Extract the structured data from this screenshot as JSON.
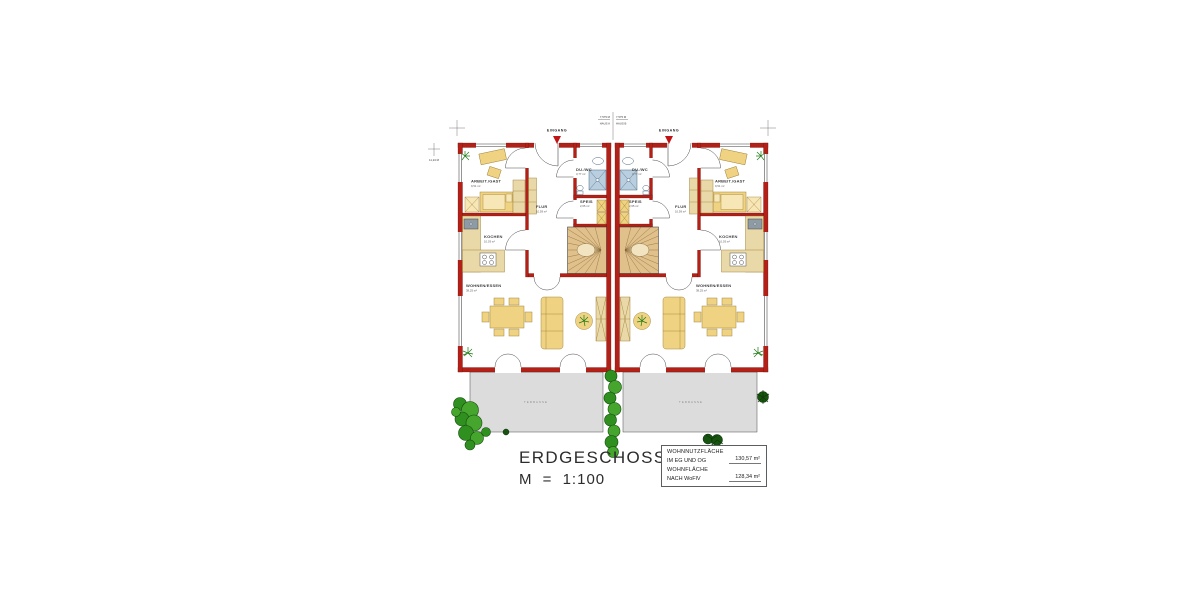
{
  "plan": {
    "title": "ERDGESCHOSS",
    "scale": "M = 1:100",
    "eingang_label": "EINGANG",
    "terrasse_label": "TERRASSE",
    "dims": {
      "width_a": "7,575 M",
      "width_b": "7,575 M",
      "haus_a": "HAUS A",
      "haus_b": "HAUS B",
      "height": "11,24 M"
    },
    "rooms": {
      "arbeit_gast": {
        "name": "ARBEIT./GAST",
        "area": "9,51 m²"
      },
      "du_wc": {
        "name": "DU./WC",
        "area": "3,77 m²"
      },
      "speis": {
        "name": "SPEIS",
        "area": "2,65 m²"
      },
      "flur": {
        "name": "FLUR",
        "area": "10,59 m²"
      },
      "kochen": {
        "name": "KOCHEN",
        "area": "10,03 m²"
      },
      "wohnen_essen": {
        "name": "WOHNEN/ESSEN",
        "area": "38,25 m²"
      }
    },
    "info_box": {
      "rows": [
        {
          "label_line1": "WOHNNUTZFLÄCHE",
          "label_line2": "IM EG UND OG",
          "value": "130,57 m²"
        },
        {
          "label_line1": "WOHNFLÄCHE",
          "label_line2": "NACH WoFlV",
          "value": "128,34 m²"
        }
      ]
    },
    "colors": {
      "wall_red": "#b32017",
      "furniture_yellow": "#f0d382",
      "tile_blue": "#b9cede",
      "terrace_gray": "#dcdcdc",
      "plant_green": "#2f8f1f"
    }
  }
}
